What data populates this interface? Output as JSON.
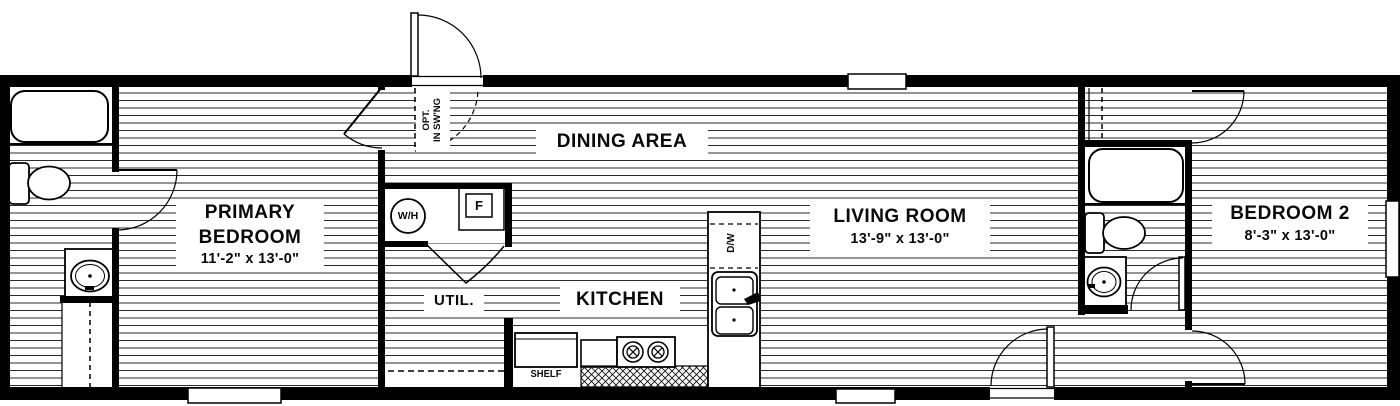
{
  "plan": {
    "title": "single-wide mobile home floor plan",
    "rooms": {
      "primary_bedroom": {
        "name_line1": "PRIMARY",
        "name_line2": "BEDROOM",
        "dims": "11'-2\" x  13'-0\""
      },
      "dining": {
        "name": "DINING AREA"
      },
      "kitchen": {
        "name": "KITCHEN"
      },
      "util": {
        "name": "UTIL."
      },
      "living": {
        "name": "LIVING ROOM",
        "dims": "13'-9\" x  13'-0\""
      },
      "bedroom2": {
        "name": "BEDROOM 2",
        "dims": "8'-3\" x  13'-0\""
      }
    },
    "fixtures": {
      "shelf": "SHELF",
      "water_heater": "W/H",
      "furnace": "F",
      "dishwasher": "D/W"
    },
    "door_note": {
      "line1": "OPT.",
      "line2": "IN SW'NG"
    },
    "colors": {
      "wall": "#000000",
      "hatch_line": "#2a2a2a",
      "background": "#ffffff"
    }
  }
}
